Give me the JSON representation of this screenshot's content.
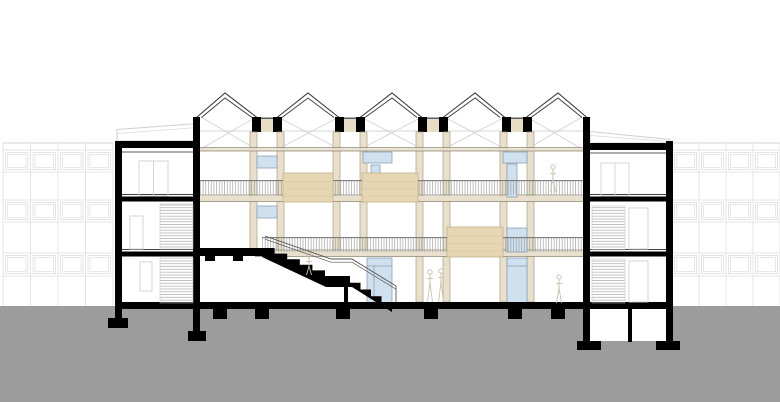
{
  "drawing_type": "architectural-building-section",
  "canvas": {
    "width": 780,
    "height": 402,
    "background": "#ffffff"
  },
  "colors": {
    "cut_black": "#000000",
    "ground_grey": "#9c9c9c",
    "timber_beige": "#e9dfca",
    "timber_band": "#e8dfcd",
    "wood_panel": "#e7d6b3",
    "wood_panel_line": "#d8c6a0",
    "glass_blue": "#cfe0ee",
    "glass_frame": "#8ba0b4",
    "roof_line": "#3c3c3c",
    "brace_grey": "#cfcfcf",
    "context_grey": "#dedede",
    "railing_grey": "#9b9b9b",
    "figure_sketch": "#cbc1ae"
  },
  "ground": {
    "rect": [
      0,
      306,
      780,
      96
    ]
  },
  "context_buildings": [
    {
      "side": "left",
      "top_y": 143,
      "bottom_y": 306,
      "mullions": [
        3,
        30.5,
        58,
        85.5,
        113
      ],
      "bands": [
        [
          150,
          172
        ],
        [
          200,
          222
        ],
        [
          253,
          276
        ]
      ]
    },
    {
      "side": "right",
      "top_y": 143,
      "bottom_y": 306,
      "mullions": [
        672,
        699,
        726,
        753,
        780
      ],
      "bands": [
        [
          150,
          172
        ],
        [
          200,
          222
        ],
        [
          253,
          276
        ]
      ]
    }
  ],
  "roof": {
    "peak_y": 93,
    "eave_y": 117.5,
    "inner_offset": 5,
    "gables": [
      [
        196.5,
        225,
        257
      ],
      [
        277,
        308,
        339
      ],
      [
        360,
        392,
        422
      ],
      [
        443,
        475,
        505
      ],
      [
        526,
        558,
        587
      ]
    ],
    "brace_bays": [
      [
        201,
        256
      ],
      [
        278,
        339
      ],
      [
        361,
        422
      ],
      [
        444,
        505
      ],
      [
        527,
        582
      ]
    ],
    "brace_top_y": 117,
    "brace_bottom_y": 149,
    "eave_line": [
      200,
      131,
      583,
      131
    ],
    "valley_centers": [
      267,
      350,
      433,
      517
    ],
    "valley_block": {
      "w": 9,
      "gap": 12,
      "y": 117,
      "h": 15
    }
  },
  "columns": {
    "y1": 132,
    "w": 7,
    "dxL": -17,
    "dxR": 10,
    "pairs": [
      {
        "c": 267,
        "y2": 250
      },
      {
        "c": 350,
        "y2": 250
      },
      {
        "c": 433,
        "y2": 302
      },
      {
        "c": 517,
        "y2": 302
      }
    ]
  },
  "bands": {
    "ceiling": {
      "x1": 200,
      "x2": 583,
      "y": 147.5,
      "h": 3.5
    },
    "slab_f3": {
      "x1": 200,
      "x2": 583,
      "y": 195,
      "h": 6.5
    },
    "slab_f2": {
      "x1": 255,
      "x2": 583,
      "y": 250,
      "h": 6.5
    }
  },
  "windows": [
    {
      "r": [
        257,
        156,
        20,
        12
      ]
    },
    {
      "r": [
        257,
        206,
        20,
        12
      ]
    },
    {
      "r": [
        363,
        152,
        29,
        11
      ]
    },
    {
      "r": [
        371,
        165,
        9,
        12
      ]
    },
    {
      "r": [
        503,
        152,
        24,
        11
      ]
    },
    {
      "r": [
        507,
        164,
        10,
        33
      ]
    },
    {
      "r": [
        507,
        228,
        20,
        24
      ]
    },
    {
      "r": [
        367,
        258,
        25,
        45
      ],
      "lines": [
        [
          367,
          266,
          392,
          266
        ],
        [
          374,
          266,
          374,
          303
        ]
      ]
    },
    {
      "r": [
        507,
        258,
        20,
        45
      ],
      "lines": [
        [
          507,
          266,
          527,
          266
        ]
      ]
    }
  ],
  "wood_panels": [
    [
      283,
      173,
      50,
      29
    ],
    [
      362,
      173,
      56,
      29
    ],
    [
      447,
      227,
      56,
      30
    ]
  ],
  "railings": [
    {
      "y": 180,
      "h": 15,
      "segments": [
        [
          200,
          283
        ],
        [
          333,
          362
        ],
        [
          418,
          583
        ]
      ]
    },
    {
      "y": 237,
      "h": 15,
      "segments": [
        [
          262,
          447
        ],
        [
          503,
          583
        ]
      ]
    }
  ],
  "stair": {
    "raised_slab": [
      198,
      248,
      64,
      8
    ],
    "support_tabs": [
      [
        205,
        256,
        10,
        5
      ],
      [
        233,
        256,
        10,
        5
      ]
    ],
    "mass_path": "M262,248 H274.6 V253.6 H287.2 V259.2 H299.8 V264.8 H312.4 V270.4 H325 V276 H350 V282.75 H360.5 V289.5 H371 V296.25 H381.5 V303 H392 V312 L352,287 H326 L262,257 Z",
    "under_wall": [
      344,
      286,
      4,
      17
    ],
    "railing_pts": "265,236 331,259 352,259 396,286",
    "railing_offset": 3.2,
    "railing_post": [
      396,
      286,
      396,
      302
    ]
  },
  "ground_slab": [
    115,
    302,
    558,
    7
  ],
  "foundation_pads": [
    [
      213,
      309,
      14,
      10
    ],
    [
      255,
      309,
      14,
      10
    ],
    [
      336,
      309,
      14,
      10
    ],
    [
      424,
      309,
      14,
      10
    ],
    [
      508,
      309,
      14,
      10
    ],
    [
      551,
      309,
      14,
      10
    ]
  ],
  "left_wing": {
    "rooms": [
      [
        122,
        148,
        71,
        155
      ]
    ],
    "parapet": "M117,141 V129.5 L198,123.5 V141 Z",
    "parapet_inner": [
      117,
      133.5,
      198,
      127.5
    ],
    "roof": [
      115,
      141,
      85,
      7
    ],
    "ceil_line": [
      122,
      152,
      193,
      152
    ],
    "walls": [
      [
        115,
        141,
        7,
        179
      ],
      [
        193,
        117,
        7,
        216
      ]
    ],
    "slabs": [
      {
        "y": 194.5,
        "x1": 122,
        "x2": 193
      },
      {
        "y": 249.5,
        "x1": 122,
        "x2": 193
      }
    ],
    "stair_hatches": [
      [
        160,
        204,
        33,
        45
      ],
      [
        160,
        258,
        33,
        45
      ]
    ],
    "door_frames": [
      {
        "r": [
          139,
          161,
          29,
          35
        ],
        "v": 153.5
      },
      {
        "r": [
          130,
          216,
          13,
          33
        ]
      },
      {
        "r": [
          140,
          262,
          12,
          29
        ]
      }
    ],
    "pads": [
      [
        108,
        318,
        20,
        10
      ],
      [
        188,
        331,
        18,
        10
      ]
    ]
  },
  "right_wing": {
    "rooms": [
      [
        590,
        150,
        76,
        153
      ],
      [
        590,
        307,
        76,
        34
      ]
    ],
    "parapet": "M590,143 V131.5 L670,139.5 V143 Z",
    "parapet_inner": [
      590,
      135.5,
      668,
      141.5
    ],
    "roof": [
      583,
      143,
      90,
      7
    ],
    "ceil_line": [
      590,
      153,
      666,
      153
    ],
    "walls": [
      [
        583,
        117,
        7,
        226
      ],
      [
        666,
        141,
        7,
        202
      ]
    ],
    "slabs": [
      {
        "y": 194.5,
        "x1": 590,
        "x2": 666
      },
      {
        "y": 249.5,
        "x1": 590,
        "x2": 666
      }
    ],
    "stair_hatches": [
      [
        592,
        206,
        33,
        44
      ],
      [
        592,
        259,
        33,
        44
      ]
    ],
    "door_frames": [
      {
        "r": [
          601,
          163,
          28,
          33
        ],
        "v": 615
      },
      {
        "r": [
          629,
          208,
          19,
          41
        ]
      },
      {
        "r": [
          629,
          261,
          19,
          41
        ]
      }
    ],
    "divider": [
      628,
      307,
      4,
      35
    ],
    "pads": [
      [
        577,
        341,
        24,
        9
      ],
      [
        656,
        341,
        24,
        9
      ]
    ]
  },
  "figures": [
    {
      "hx": 309,
      "hy": 255,
      "foot": 275
    },
    {
      "hx": 430,
      "hy": 272,
      "foot": 302
    },
    {
      "hx": 441,
      "hy": 271,
      "foot": 302
    },
    {
      "hx": 559,
      "hy": 277,
      "foot": 303
    },
    {
      "hx": 553,
      "hy": 167,
      "foot": 192
    }
  ]
}
